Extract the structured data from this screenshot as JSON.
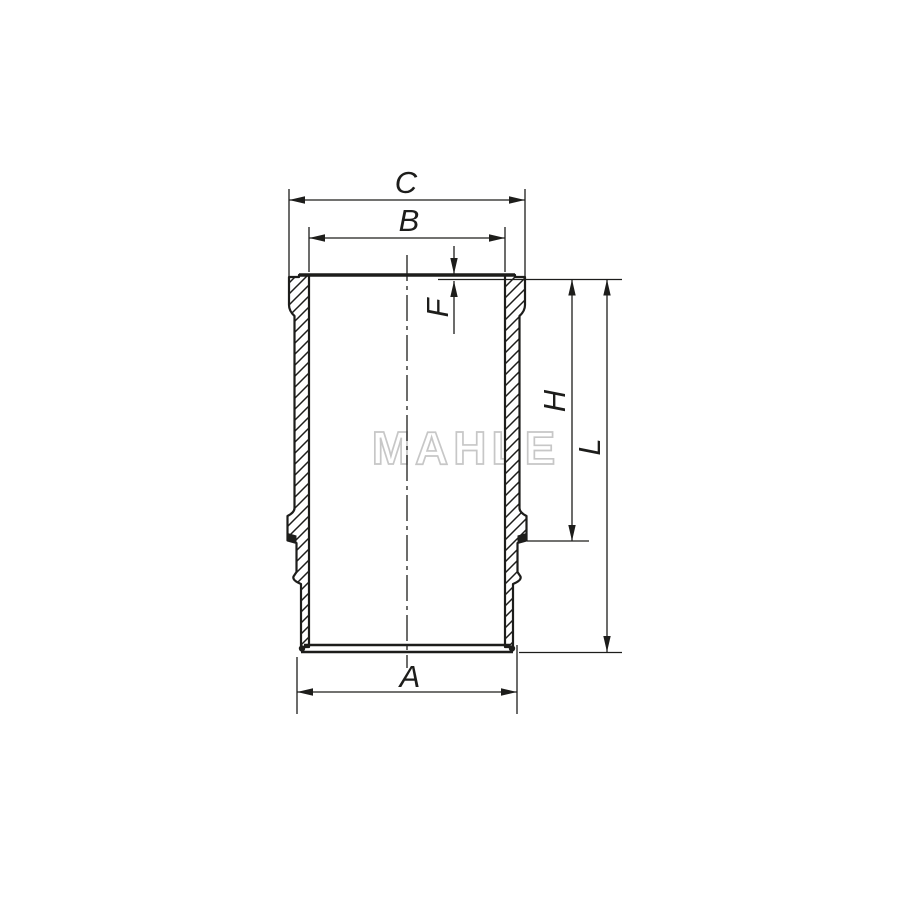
{
  "diagram": {
    "type": "technical_drawing",
    "subject": "cylinder liner cross-section",
    "watermark": {
      "text": "MAHLE"
    },
    "labels": {
      "c": "C",
      "b": "B",
      "f": "F",
      "h": "H",
      "l": "L",
      "a": "A"
    },
    "dimension_roles": {
      "C": "flange outer diameter (top)",
      "B": "bore diameter (top)",
      "F": "flange step height",
      "H": "height from top face to lower collar step",
      "L": "total liner length",
      "A": "bottom outer diameter"
    },
    "colors": {
      "line": "#1d1d1b",
      "watermark_outline": "#c7c7c7",
      "background": "#ffffff"
    }
  }
}
